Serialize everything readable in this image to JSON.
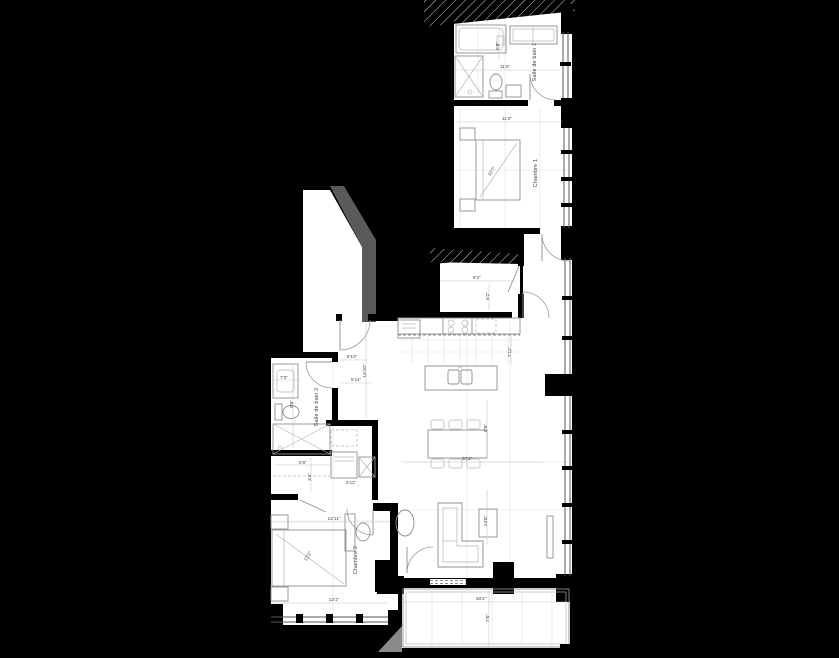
{
  "colors": {
    "background": "#000000",
    "floor": "#ffffff",
    "wall": "#000000",
    "furniture_line": "#8f8f8f",
    "dimension_text": "#4a4a4a",
    "shadow": "#5a5a5a",
    "balcony_shadow": "#8a8a8a"
  },
  "plan": {
    "rooms": [
      {
        "id": "chambre-1",
        "label": "Chambre 1"
      },
      {
        "id": "salle-de-bain-1",
        "label": "Salle de bain 1"
      },
      {
        "id": "chambre-2",
        "label": "Chambre 2"
      },
      {
        "id": "salle-de-bain-2",
        "label": "Salle de bain 2"
      }
    ],
    "dims": [
      {
        "text": "11'2\""
      },
      {
        "text": "5'8\""
      },
      {
        "text": "11'2\""
      },
      {
        "text": "10'7\""
      },
      {
        "text": "8'2\""
      },
      {
        "text": "6'2\""
      },
      {
        "text": "7'11\""
      },
      {
        "text": "8'8\""
      },
      {
        "text": "20'1\""
      },
      {
        "text": "13'8\""
      },
      {
        "text": "18'2\""
      },
      {
        "text": "7'6\""
      },
      {
        "text": "12'11\""
      },
      {
        "text": "13'2\""
      },
      {
        "text": "13'1\""
      },
      {
        "text": "7'0\""
      },
      {
        "text": "9'6\""
      },
      {
        "text": "6'10\""
      },
      {
        "text": "13'10\""
      },
      {
        "text": "5'11\""
      },
      {
        "text": "5'6\""
      },
      {
        "text": "3'4\""
      },
      {
        "text": "2'11\""
      }
    ]
  }
}
